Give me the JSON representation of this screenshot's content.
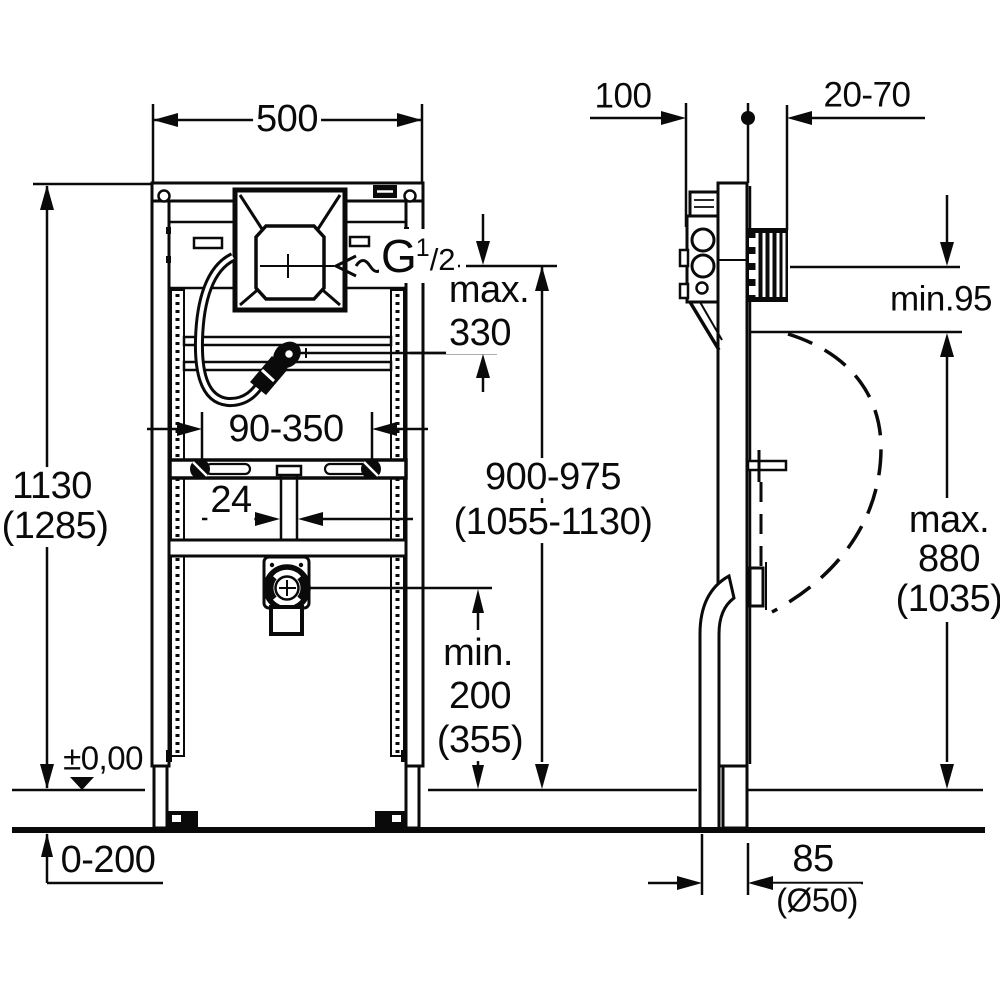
{
  "colors": {
    "line": "#0a0a0a",
    "background": "#ffffff"
  },
  "labels": {
    "frame_width": "500",
    "frame_height": "1130",
    "frame_height_alt": "(1285)",
    "top_depth": "100",
    "wall_offset": "20-70",
    "rim_clearance": "min.95",
    "supply_max_word": "max.",
    "supply_max_value": "330",
    "thread_letter": "G",
    "thread_num": "1",
    "thread_den": "/2",
    "bracket_range": "90-350",
    "pipe_width": "24",
    "flush_height": "900-975",
    "flush_height_alt": "(1055-1130)",
    "rim_height_word": "max.",
    "rim_height_value": "880",
    "rim_height_alt": "(1035)",
    "drain_min_word": "min.",
    "drain_min_value": "200",
    "drain_min_alt": "(355)",
    "zero_level": "±0,00",
    "floor_range": "0-200",
    "drain_offset": "85",
    "drain_diameter": "(Ø50)"
  }
}
